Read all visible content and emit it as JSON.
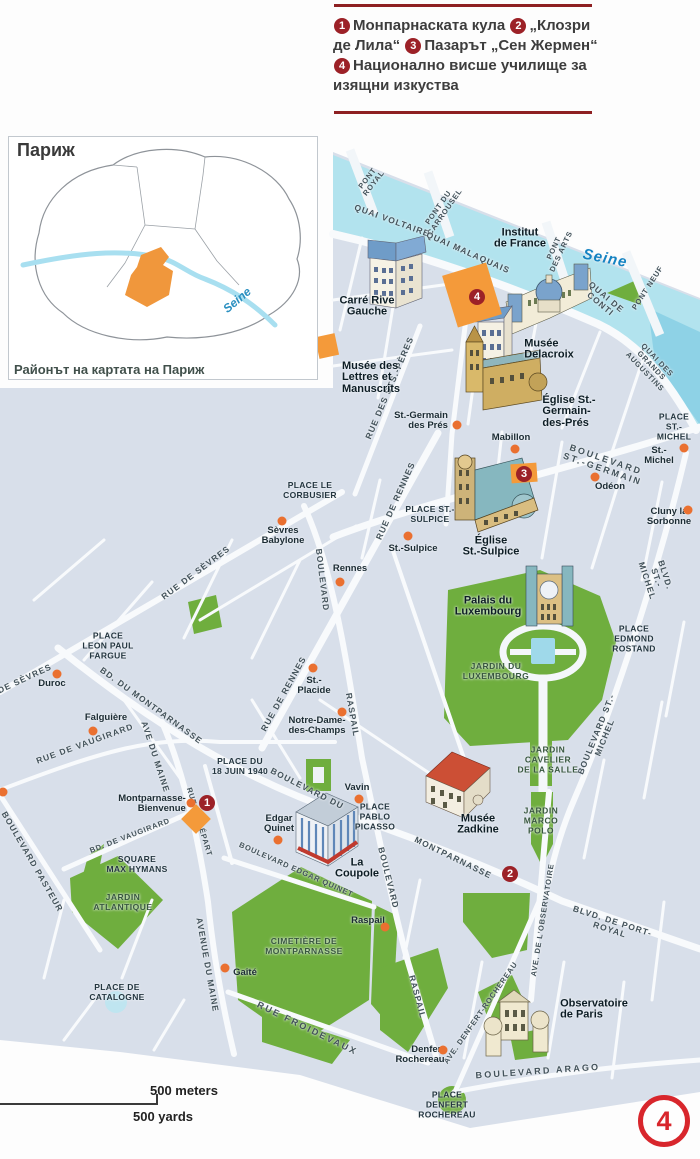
{
  "page": {
    "badge": "4"
  },
  "legend": {
    "items": [
      {
        "num": "1",
        "text": "Монпарнаската кула"
      },
      {
        "num": "2",
        "text": "„Клозри де Лила“"
      },
      {
        "num": "3",
        "text": "Пазарът „Сен Жермен“"
      },
      {
        "num": "4",
        "text": "Национално висше училище за изящни изкуства"
      }
    ]
  },
  "inset": {
    "title": "Париж",
    "caption": "Районът на картата на Париж",
    "river_label": "Seine"
  },
  "scalebar": {
    "meters": "500 meters",
    "yards": "500 yards"
  },
  "colors": {
    "accent_red": "#9c2127",
    "page_ring_red": "#d8262c",
    "orange_marker": "#f49a3a",
    "metro_dot": "#ea7030",
    "water": "#b2e3ee",
    "park": "#6fae3e",
    "map_bg": "#d8dfea"
  },
  "map": {
    "labels": [
      {
        "t": "Seine",
        "x": 605,
        "y": 259,
        "r": 11,
        "c": "wa"
      },
      {
        "t": "PONT\nROYAL",
        "x": 371,
        "y": 181,
        "r": -52,
        "c": "sts"
      },
      {
        "t": "QUAI VOLTAIRE",
        "x": 392,
        "y": 221,
        "r": 20,
        "c": "st"
      },
      {
        "t": "PONT DU\nCARROUSEL",
        "x": 442,
        "y": 210,
        "r": -55,
        "c": "sts"
      },
      {
        "t": "QUAI MALAQUAIS",
        "x": 468,
        "y": 253,
        "r": 24,
        "c": "st"
      },
      {
        "t": "PONT\nDES ARTS",
        "x": 558,
        "y": 250,
        "r": -65,
        "c": "sts"
      },
      {
        "t": "QUAI DE\nCONTI",
        "x": 603,
        "y": 301,
        "r": 40,
        "c": "st"
      },
      {
        "t": "PONT NEUF",
        "x": 648,
        "y": 288,
        "r": -57,
        "c": "sts"
      },
      {
        "t": "QUAI DES GRANDS AUGUSTINS",
        "x": 651,
        "y": 366,
        "r": 46,
        "c": "sts"
      },
      {
        "t": "RUE DES STS.-PÈRES",
        "x": 390,
        "y": 388,
        "r": -67,
        "c": "st"
      },
      {
        "t": "BOULEVARD ST.-GERMAIN",
        "x": 604,
        "y": 465,
        "r": 19,
        "c": "stw"
      },
      {
        "t": "RUE DE RENNES",
        "x": 396,
        "y": 501,
        "r": -66,
        "c": "st"
      },
      {
        "t": "RUE DE RENNES",
        "x": 284,
        "y": 694,
        "r": -61,
        "c": "st"
      },
      {
        "t": "BOULEVARD",
        "x": 322,
        "y": 580,
        "r": 83,
        "c": "st"
      },
      {
        "t": "RASPAIL",
        "x": 352,
        "y": 715,
        "r": 80,
        "c": "st"
      },
      {
        "t": "RUE DE SÈVRES",
        "x": 196,
        "y": 573,
        "r": -37,
        "c": "st"
      },
      {
        "t": "DE SÈVRES",
        "x": 25,
        "y": 679,
        "r": -25,
        "c": "st"
      },
      {
        "t": "BLVD. ST.-MICHEL",
        "x": 656,
        "y": 578,
        "r": 72,
        "c": "st"
      },
      {
        "t": "BOULEVARD ST.-MICHEL",
        "x": 601,
        "y": 736,
        "r": -68,
        "c": "st"
      },
      {
        "t": "BD. DU MONTPARNASSE",
        "x": 151,
        "y": 706,
        "r": 36,
        "c": "st"
      },
      {
        "t": "RUE DE VAUGIRARD",
        "x": 85,
        "y": 744,
        "r": -20,
        "c": "st"
      },
      {
        "t": "AVE DU MAINE",
        "x": 155,
        "y": 757,
        "r": 72,
        "c": "st"
      },
      {
        "t": "BOULEVARD DU",
        "x": 307,
        "y": 789,
        "r": 27,
        "c": "st"
      },
      {
        "t": "MONTPARNASSE",
        "x": 453,
        "y": 858,
        "r": 26,
        "c": "st"
      },
      {
        "t": "RUE DU DÉPART",
        "x": 199,
        "y": 822,
        "r": 73,
        "c": "sts"
      },
      {
        "t": "BD. DE VAUGIRARD",
        "x": 130,
        "y": 836,
        "r": -21,
        "c": "sts"
      },
      {
        "t": "BOULEVARD PASTEUR",
        "x": 32,
        "y": 862,
        "r": 60,
        "c": "st"
      },
      {
        "t": "BOULEVARD EDGAR QUINET",
        "x": 296,
        "y": 870,
        "r": 24,
        "c": "sts"
      },
      {
        "t": "BOULEVARD",
        "x": 388,
        "y": 878,
        "r": 76,
        "c": "st"
      },
      {
        "t": "RASPAIL",
        "x": 417,
        "y": 997,
        "r": 75,
        "c": "st"
      },
      {
        "t": "AVENUE DU MAINE",
        "x": 207,
        "y": 965,
        "r": 80,
        "c": "st"
      },
      {
        "t": "RUE FROIDEVAUX",
        "x": 307,
        "y": 1029,
        "r": 26,
        "c": "stw"
      },
      {
        "t": "BLVD. DE PORT-ROYAL",
        "x": 611,
        "y": 926,
        "r": 18,
        "c": "st"
      },
      {
        "t": "AVE. DE L'OBSERVATOIRE",
        "x": 543,
        "y": 920,
        "r": -81,
        "c": "sts"
      },
      {
        "t": "AVE. DENFERT-ROCHEREAU",
        "x": 481,
        "y": 1013,
        "r": -55,
        "c": "sts"
      },
      {
        "t": "BOULEVARD ARAGO",
        "x": 538,
        "y": 1072,
        "r": -4,
        "c": "stw"
      },
      {
        "t": "PLACE\nST.- MICHEL",
        "x": 674,
        "y": 427,
        "c": "pl"
      },
      {
        "t": "PLACE LE\nCORBUSIER",
        "x": 310,
        "y": 491,
        "c": "pl"
      },
      {
        "t": "PLACE ST.-\nSULPICE",
        "x": 430,
        "y": 515,
        "c": "pl"
      },
      {
        "t": "PLACE\nEDMOND\nROSTAND",
        "x": 634,
        "y": 639,
        "c": "pl"
      },
      {
        "t": "PLACE\nLEON PAUL\nFARGUE",
        "x": 108,
        "y": 646,
        "c": "pl"
      },
      {
        "t": "PLACE DU\n18 JUIN 1940",
        "x": 240,
        "y": 767,
        "c": "pl"
      },
      {
        "t": "PLACE\nPABLO\nPICASSO",
        "x": 375,
        "y": 817,
        "c": "pl"
      },
      {
        "t": "SQUARE\nMAX HYMANS",
        "x": 137,
        "y": 865,
        "c": "pl"
      },
      {
        "t": "PLACE DE\nCATALOGNE",
        "x": 117,
        "y": 993,
        "c": "pl"
      },
      {
        "t": "PLACE\nDENFERT\nROCHEREAU",
        "x": 447,
        "y": 1105,
        "c": "pl"
      },
      {
        "t": "JARDIN DU\nLUXEMBOURG",
        "x": 496,
        "y": 671,
        "c": "pa"
      },
      {
        "t": "JARDIN\nCAVELIER\nDE LA SALLE",
        "x": 548,
        "y": 760,
        "c": "pa"
      },
      {
        "t": "JARDIN\nMARCO\nPOLO",
        "x": 541,
        "y": 821,
        "c": "pa"
      },
      {
        "t": "JARDIN\nATLANTIQUE",
        "x": 123,
        "y": 902,
        "c": "pa"
      },
      {
        "t": "CIMETIÈRE DE\nMONTPARNASSE",
        "x": 304,
        "y": 946,
        "c": "pa"
      },
      {
        "t": "Institut\nde France",
        "x": 520,
        "y": 239,
        "c": "si"
      },
      {
        "t": "Carré Rive\nGauche",
        "x": 367,
        "y": 307,
        "c": "si"
      },
      {
        "t": "Musée des\nLettres et\nManuscrits",
        "x": 371,
        "y": 378,
        "c": "si",
        "a": "l"
      },
      {
        "t": "Musée\nDelacroix",
        "x": 549,
        "y": 350,
        "c": "si",
        "a": "l"
      },
      {
        "t": "Église St.-\nGermain-\ndes-Prés",
        "x": 569,
        "y": 412,
        "c": "si",
        "a": "l"
      },
      {
        "t": "Église\nSt.-Sulpice",
        "x": 491,
        "y": 547,
        "c": "si"
      },
      {
        "t": "Palais du\nLuxembourg",
        "x": 488,
        "y": 607,
        "c": "si"
      },
      {
        "t": "Musée\nZadkine",
        "x": 478,
        "y": 825,
        "c": "si"
      },
      {
        "t": "La\nCoupole",
        "x": 357,
        "y": 869,
        "c": "si"
      },
      {
        "t": "Observatoire\nde Paris",
        "x": 594,
        "y": 1010,
        "c": "si",
        "a": "l"
      },
      {
        "t": "St.-Germain\ndes Prés",
        "x": 421,
        "y": 421,
        "c": "me",
        "a": "r"
      },
      {
        "t": "Mabillon",
        "x": 511,
        "y": 438,
        "c": "me"
      },
      {
        "t": "St.-Michel",
        "x": 659,
        "y": 456,
        "c": "me"
      },
      {
        "t": "Odéon",
        "x": 610,
        "y": 487,
        "c": "me"
      },
      {
        "t": "Cluny la\nSorbonne",
        "x": 669,
        "y": 517,
        "c": "me"
      },
      {
        "t": "St.-Sulpice",
        "x": 413,
        "y": 549,
        "c": "me"
      },
      {
        "t": "Sèvres\nBabylone",
        "x": 283,
        "y": 536,
        "c": "me"
      },
      {
        "t": "Rennes",
        "x": 350,
        "y": 569,
        "c": "me"
      },
      {
        "t": "Duroc",
        "x": 52,
        "y": 684,
        "c": "me"
      },
      {
        "t": "Falguière",
        "x": 106,
        "y": 718,
        "c": "me"
      },
      {
        "t": "St.-\nPlacide",
        "x": 314,
        "y": 686,
        "c": "me"
      },
      {
        "t": "Notre-Dame-\ndes-Champs",
        "x": 317,
        "y": 726,
        "c": "me"
      },
      {
        "t": "Montparnasse-\nBienvenue",
        "x": 152,
        "y": 804,
        "c": "me",
        "a": "r"
      },
      {
        "t": "Vavin",
        "x": 357,
        "y": 788,
        "c": "me"
      },
      {
        "t": "Edgar\nQuinet",
        "x": 279,
        "y": 824,
        "c": "me"
      },
      {
        "t": "Raspail",
        "x": 368,
        "y": 921,
        "c": "me"
      },
      {
        "t": "Gaîté",
        "x": 245,
        "y": 973,
        "c": "me"
      },
      {
        "t": "Denfert\nRochereau",
        "x": 420,
        "y": 1055,
        "c": "me",
        "a": "r"
      }
    ],
    "metro_dots": [
      [
        457,
        425
      ],
      [
        515,
        449
      ],
      [
        684,
        448
      ],
      [
        595,
        477
      ],
      [
        688,
        510
      ],
      [
        408,
        536
      ],
      [
        282,
        521
      ],
      [
        340,
        582
      ],
      [
        313,
        668
      ],
      [
        342,
        712
      ],
      [
        57,
        674
      ],
      [
        93,
        731
      ],
      [
        191,
        803
      ],
      [
        359,
        799
      ],
      [
        278,
        840
      ],
      [
        385,
        927
      ],
      [
        225,
        968
      ],
      [
        443,
        1050
      ],
      [
        3,
        792
      ]
    ],
    "sight_markers": [
      {
        "x": 472,
        "y": 295,
        "w": 46,
        "h": 54,
        "r": -17
      },
      {
        "x": 524,
        "y": 473,
        "w": 26,
        "h": 19,
        "r": -4
      },
      {
        "x": 196,
        "y": 819,
        "w": 21,
        "h": 21,
        "r": 45
      },
      {
        "x": 327,
        "y": 346,
        "w": 20,
        "h": 22,
        "r": -12
      }
    ],
    "badges": [
      {
        "n": "1",
        "x": 207,
        "y": 803
      },
      {
        "n": "2",
        "x": 510,
        "y": 874
      },
      {
        "n": "3",
        "x": 524,
        "y": 474
      },
      {
        "n": "4",
        "x": 477,
        "y": 297
      }
    ]
  }
}
